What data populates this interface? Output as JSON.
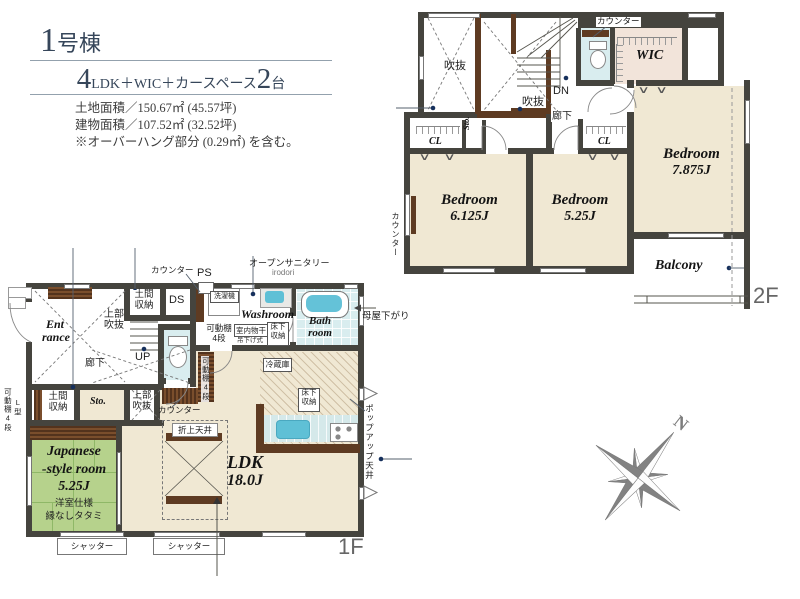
{
  "header": {
    "no": "1",
    "no_suffix": "号棟",
    "plan_big1": "4",
    "plan_mid": "LDK＋WIC＋カースペース",
    "plan_big2": "2",
    "plan_tail": "台",
    "line1": "土地面積／150.67㎡ (45.57坪)",
    "line2": "建物面積／107.52㎡ (32.52坪)",
    "line3": "※オーバーハング部分 (0.29㎡) を含む。"
  },
  "f2": {
    "floor": "2F",
    "void1": "吹抜",
    "void2": "吹抜",
    "dn": "DN",
    "counter_top": "カウンター",
    "counter_left": "カウンター",
    "wic": "WIC",
    "hall": "廊下",
    "cl": "CL",
    "sto": "Sto.",
    "b1n": "Bedroom",
    "b1s": "6.125J",
    "b2n": "Bedroom",
    "b2s": "5.25J",
    "b3n": "Bedroom",
    "b3s": "7.875J",
    "balcony": "Balcony",
    "mark": "∨"
  },
  "f1": {
    "floor": "1F",
    "ent1": "Ent",
    "ent2": "rance",
    "hall": "廊下",
    "void_u1": "上部",
    "void_u2": "吹抜",
    "doma1": "土間",
    "doma2": "収納",
    "ds": "DS",
    "ps": "PS",
    "counter": "カウンター",
    "up": "UP",
    "sto": "Sto.",
    "shelf1": "可動棚",
    "shelf2": "4段",
    "shelf_v": "可動棚4段",
    "l_type": "L型",
    "washer": "洗濯機",
    "open_san": "オープンサニタリー",
    "irodori": "irodori",
    "washroom": "Washroom",
    "bath1": "Bath",
    "bath2": "room",
    "dry1": "室内物干",
    "dry2": "吊下げ式",
    "fs1": "床下",
    "fs2": "収納",
    "fridge": "冷蔵庫",
    "ldk1": "LDK",
    "ldk2": "18.0J",
    "coffered": "折上天井",
    "jp1": "Japanese",
    "jp2": "-style room",
    "jp3": "5.25J",
    "jp4": "洋室仕様",
    "jp5": "縁なしタタミ",
    "shutter": "シャッター",
    "popup": "ポップアップ天井",
    "moya": "母屋下がり"
  },
  "compass": {
    "n": "N"
  }
}
